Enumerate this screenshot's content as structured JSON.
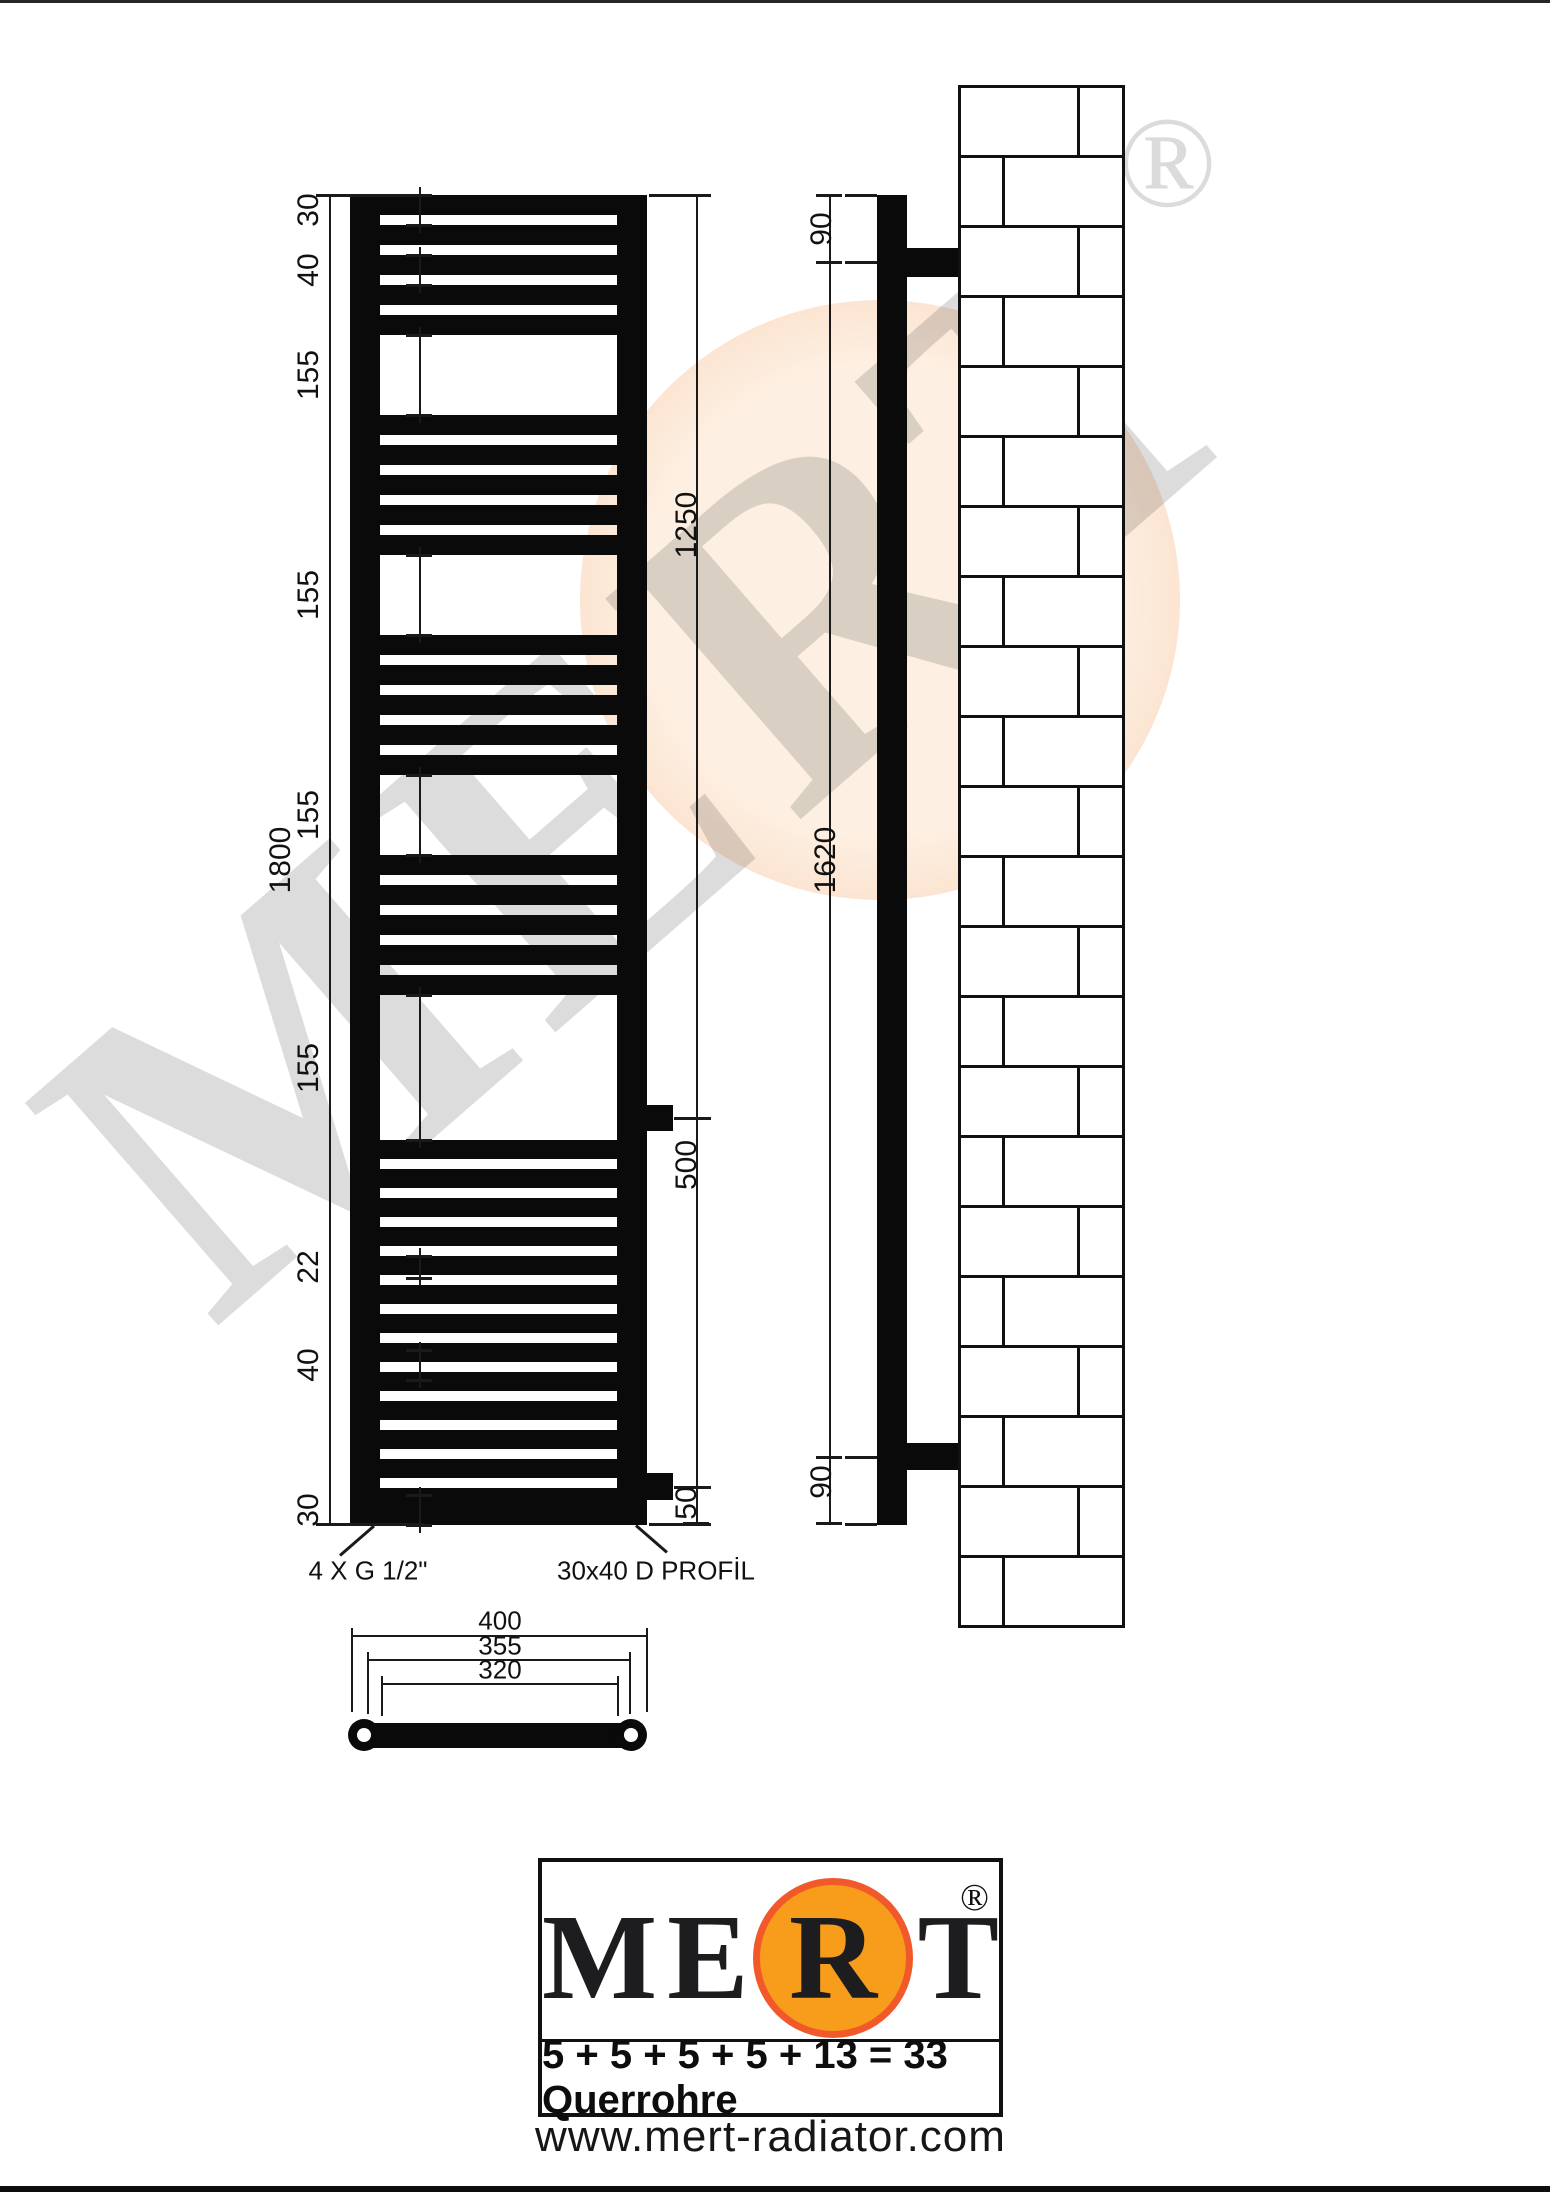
{
  "watermark": {
    "text": "MERT",
    "reg": "®"
  },
  "front_view": {
    "height_dim": "1800",
    "left_dims": [
      "30",
      "40",
      "155",
      "155",
      "155",
      "155",
      "22",
      "40",
      "30"
    ],
    "right_dims": [
      "1250",
      "500",
      "50"
    ],
    "annotations": {
      "connections": "4 X G 1/2\"",
      "profile": "30x40 D PROFİL"
    }
  },
  "side_view": {
    "dims": [
      "90",
      "1620",
      "90"
    ]
  },
  "top_view": {
    "width_dims": [
      "400",
      "355",
      "320"
    ]
  },
  "radiator": {
    "tube_groups": [
      5,
      5,
      5,
      5
    ],
    "bottom_group": 13
  },
  "logo": {
    "letters": [
      "M",
      "E",
      "R",
      "T"
    ],
    "registered": "®",
    "formula": "5 + 5 + 5 + 5 + 13 = 33 Querrohre",
    "website": "www.mert-radiator.com"
  },
  "colors": {
    "orange_fill": "#F89C1C",
    "orange_ring": "#F1592A",
    "peach": "#FBDCC6",
    "ink": "#0A0A0A"
  }
}
